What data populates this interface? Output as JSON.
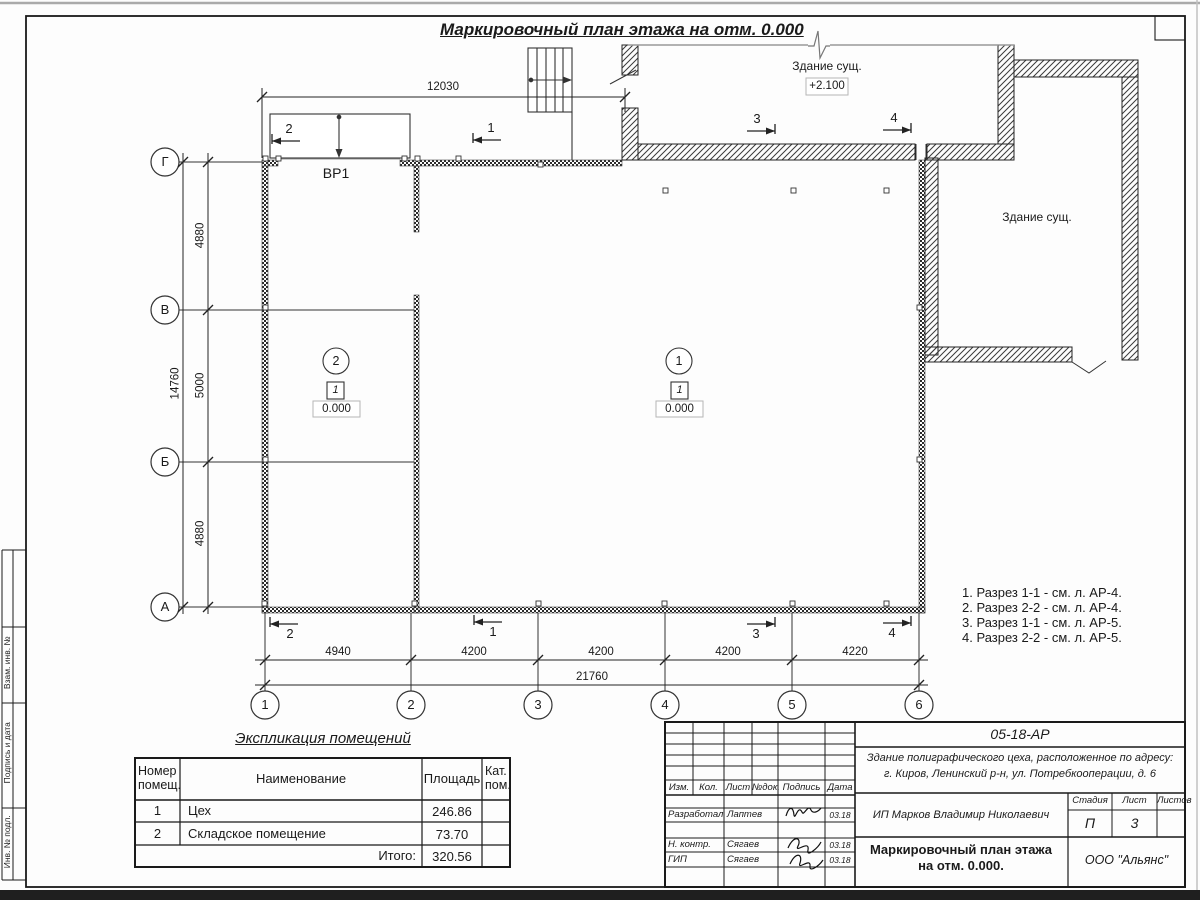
{
  "sheet": {
    "title": "Маркировочный план этажа на отм. 0.000"
  },
  "axes": {
    "rows": [
      "Г",
      "В",
      "Б",
      "А"
    ],
    "cols": [
      "1",
      "2",
      "3",
      "4",
      "5",
      "6"
    ]
  },
  "dims": {
    "top": "12030",
    "left": [
      "4880",
      "5000",
      "4880"
    ],
    "left_total": "14760",
    "bottom": [
      "4940",
      "4200",
      "4200",
      "4200",
      "4220"
    ],
    "bottom_total": "21760"
  },
  "plan": {
    "gate_label": "ВР1",
    "existing_top_label": "Здание сущ.",
    "existing_top_elev": "+2.100",
    "existing_right_label": "Здание сущ.",
    "room1": {
      "num": "1",
      "mark": "1",
      "elev": "0.000"
    },
    "room2": {
      "num": "2",
      "mark": "1",
      "elev": "0.000"
    },
    "sections": {
      "s1": "1",
      "s2": "2",
      "s3": "3",
      "s4": "4"
    }
  },
  "notes": [
    "1. Разрез 1-1 - см. л. АР-4.",
    "2. Разрез 2-2 - см. л. АР-4.",
    "3. Разрез 1-1 - см. л. АР-5.",
    "4. Разрез 2-2 - см. л. АР-5."
  ],
  "schedule": {
    "title": "Экспликация помещений",
    "headers": {
      "number": "Номер помещ.",
      "name": "Наименование",
      "area": "Площадь",
      "cat": "Кат. пом."
    },
    "rows": [
      {
        "number": "1",
        "name": "Цех",
        "area": "246.86"
      },
      {
        "number": "2",
        "name": "Складское помещение",
        "area": "73.70"
      }
    ],
    "total_label": "Итого:",
    "total": "320.56"
  },
  "stamp": {
    "doc_number": "05-18-АР",
    "object_line1": "Здание полиграфического цеха, расположенное по адресу:",
    "object_line2": "г. Киров,  Ленинский р-н, ул. Потребкооперации, д. 6",
    "client": "ИП Марков Владимир Николаевич",
    "sheet_title_line1": "Маркировочный план этажа",
    "sheet_title_line2": "на отм. 0.000.",
    "company": "ООО \"Альянс\"",
    "stage_label": "Стадия",
    "stage": "П",
    "sheet_label": "Лист",
    "sheet": "3",
    "sheets_label": "Листов",
    "cols": [
      "Изм.",
      "Кол.",
      "Лист",
      "№док.",
      "Подпись",
      "Дата"
    ],
    "sig_rows": [
      {
        "role": "Разработал",
        "name": "Лаптев",
        "date": "03.18"
      },
      {
        "role": "Н. контр.",
        "name": "Сягаев",
        "date": "03.18"
      },
      {
        "role": "ГИП",
        "name": "Сягаев",
        "date": "03.18"
      }
    ]
  },
  "margin_labels": [
    "Взам. инв. №",
    "Подпись и дата",
    "Инв. № подл."
  ]
}
